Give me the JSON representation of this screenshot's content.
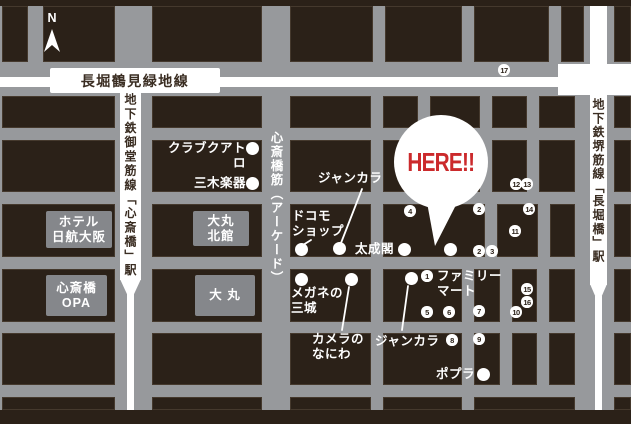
{
  "colors": {
    "block_brown": "#2b2118",
    "street_gray": "#97999c",
    "building_gray": "#85878b",
    "road_white": "#ffffff",
    "accent_red": "#cb2a2c",
    "dark_text": "#3a2d22"
  },
  "compass": {
    "label": "N"
  },
  "roads": {
    "nagahori_line": "長堀鶴見緑地線",
    "midosuji_station": "地下鉄御堂筋線「心斎橋」駅",
    "sakaisuji_station": "地下鉄堺筋線「長堀橋」駅",
    "arcade": "心斎橋筋（アーケード）"
  },
  "here": {
    "label": "HERE!!",
    "target_dot": [
      450,
      249
    ]
  },
  "buildings": [
    {
      "id": "hotel-nikko-osaka",
      "lines": [
        "ホテル",
        "日航大阪"
      ],
      "x": 46,
      "y": 211,
      "w": 66,
      "h": 37
    },
    {
      "id": "shinsaibashi-opa",
      "lines": [
        "心斎橋",
        "OPA"
      ],
      "x": 46,
      "y": 275,
      "w": 61,
      "h": 41
    },
    {
      "id": "daimaru-north-annex",
      "lines": [
        "大丸",
        "北館"
      ],
      "x": 193,
      "y": 211,
      "w": 56,
      "h": 35
    },
    {
      "id": "daimaru",
      "lines": [
        "大 丸"
      ],
      "x": 195,
      "y": 275,
      "w": 60,
      "h": 41
    }
  ],
  "pois": [
    {
      "id": "club-quattro",
      "lines": [
        "クラブクアトロ"
      ],
      "x": 158,
      "y": 141,
      "w": 88,
      "align": "right",
      "dot": [
        252,
        148
      ]
    },
    {
      "id": "miki-gakki",
      "lines": [
        "三木楽器"
      ],
      "x": 194,
      "y": 176,
      "w": 52,
      "align": "right",
      "dot": [
        252,
        183
      ]
    },
    {
      "id": "docomo-shop",
      "lines": [
        "ドコモ",
        "ショップ"
      ],
      "x": 292,
      "y": 209,
      "dot": [
        301,
        249
      ],
      "leader": [
        311,
        240,
        303,
        245
      ]
    },
    {
      "id": "jankara-north",
      "lines": [
        "ジャンカラ"
      ],
      "x": 318,
      "y": 171,
      "dot": [
        339,
        248
      ],
      "leader": [
        362,
        189,
        341,
        243
      ]
    },
    {
      "id": "taiseikaku",
      "lines": [
        "太成閣"
      ],
      "x": 355,
      "y": 242,
      "dot": [
        404,
        249
      ]
    },
    {
      "id": "family-mart",
      "lines": [
        "ファミリー",
        "マート"
      ],
      "x": 437,
      "y": 269
    },
    {
      "id": "megane-no-sanjo",
      "lines": [
        "メガネの",
        "三城"
      ],
      "x": 291,
      "y": 286,
      "dot": [
        301,
        279
      ]
    },
    {
      "id": "camera-no-naniwa",
      "lines": [
        "カメラの",
        "なにわ"
      ],
      "x": 312,
      "y": 332,
      "dot": [
        351,
        279
      ],
      "leader": [
        349,
        287,
        342,
        330
      ]
    },
    {
      "id": "jankara-south",
      "lines": [
        "ジャンカラ"
      ],
      "x": 375,
      "y": 334,
      "dot": [
        411,
        278
      ],
      "leader": [
        408,
        286,
        402,
        330
      ]
    },
    {
      "id": "poplar",
      "lines": [
        "ポプラ"
      ],
      "x": 436,
      "y": 367,
      "dot": [
        483,
        374
      ]
    }
  ],
  "numbered_markers": [
    {
      "n": "1",
      "cx": 427,
      "cy": 276
    },
    {
      "n": "2",
      "cx": 479,
      "cy": 209
    },
    {
      "n": "2",
      "cx": 479,
      "cy": 251
    },
    {
      "n": "3",
      "cx": 492,
      "cy": 251
    },
    {
      "n": "4",
      "cx": 410,
      "cy": 211
    },
    {
      "n": "5",
      "cx": 427,
      "cy": 312
    },
    {
      "n": "6",
      "cx": 449,
      "cy": 312
    },
    {
      "n": "7",
      "cx": 479,
      "cy": 311
    },
    {
      "n": "8",
      "cx": 452,
      "cy": 340
    },
    {
      "n": "9",
      "cx": 479,
      "cy": 339
    },
    {
      "n": "10",
      "cx": 516,
      "cy": 312
    },
    {
      "n": "11",
      "cx": 515,
      "cy": 231
    },
    {
      "n": "12",
      "cx": 516,
      "cy": 184
    },
    {
      "n": "13",
      "cx": 527,
      "cy": 184
    },
    {
      "n": "14",
      "cx": 529,
      "cy": 209
    },
    {
      "n": "15",
      "cx": 527,
      "cy": 289
    },
    {
      "n": "16",
      "cx": 527,
      "cy": 302
    },
    {
      "n": "17",
      "cx": 504,
      "cy": 70
    }
  ],
  "blocks": [
    [
      2,
      6,
      26,
      56
    ],
    [
      43,
      6,
      72,
      56
    ],
    [
      152,
      6,
      110,
      56
    ],
    [
      290,
      6,
      83,
      56
    ],
    [
      385,
      6,
      77,
      56
    ],
    [
      474,
      6,
      75,
      56
    ],
    [
      561,
      6,
      23,
      56
    ],
    [
      614,
      6,
      17,
      56
    ],
    [
      2,
      96,
      113,
      32
    ],
    [
      152,
      96,
      110,
      32
    ],
    [
      290,
      96,
      81,
      32
    ],
    [
      383,
      96,
      35,
      32
    ],
    [
      430,
      96,
      50,
      32
    ],
    [
      492,
      96,
      35,
      32
    ],
    [
      539,
      96,
      36,
      32
    ],
    [
      614,
      96,
      17,
      32
    ],
    [
      2,
      140,
      113,
      52
    ],
    [
      152,
      140,
      110,
      52
    ],
    [
      290,
      140,
      81,
      52
    ],
    [
      383,
      140,
      35,
      52
    ],
    [
      430,
      140,
      50,
      52
    ],
    [
      492,
      140,
      35,
      52
    ],
    [
      539,
      140,
      36,
      52
    ],
    [
      614,
      140,
      17,
      52
    ],
    [
      2,
      204,
      113,
      53
    ],
    [
      152,
      204,
      110,
      53
    ],
    [
      290,
      204,
      81,
      53
    ],
    [
      383,
      204,
      102,
      53
    ],
    [
      497,
      204,
      41,
      53
    ],
    [
      550,
      204,
      25,
      53
    ],
    [
      614,
      204,
      17,
      53
    ],
    [
      2,
      269,
      113,
      53
    ],
    [
      152,
      269,
      110,
      53
    ],
    [
      290,
      269,
      81,
      53
    ],
    [
      383,
      269,
      79,
      53
    ],
    [
      474,
      269,
      26,
      53
    ],
    [
      512,
      269,
      25,
      53
    ],
    [
      549,
      269,
      26,
      53
    ],
    [
      614,
      269,
      17,
      53
    ],
    [
      2,
      333,
      113,
      52
    ],
    [
      152,
      333,
      110,
      52
    ],
    [
      290,
      333,
      81,
      52
    ],
    [
      383,
      333,
      79,
      52
    ],
    [
      474,
      333,
      26,
      52
    ],
    [
      512,
      333,
      25,
      52
    ],
    [
      549,
      333,
      26,
      52
    ],
    [
      614,
      333,
      17,
      52
    ],
    [
      2,
      397,
      113,
      13
    ],
    [
      152,
      397,
      110,
      13
    ],
    [
      290,
      397,
      81,
      13
    ],
    [
      383,
      397,
      79,
      13
    ],
    [
      474,
      397,
      101,
      13
    ],
    [
      614,
      397,
      17,
      13
    ]
  ]
}
